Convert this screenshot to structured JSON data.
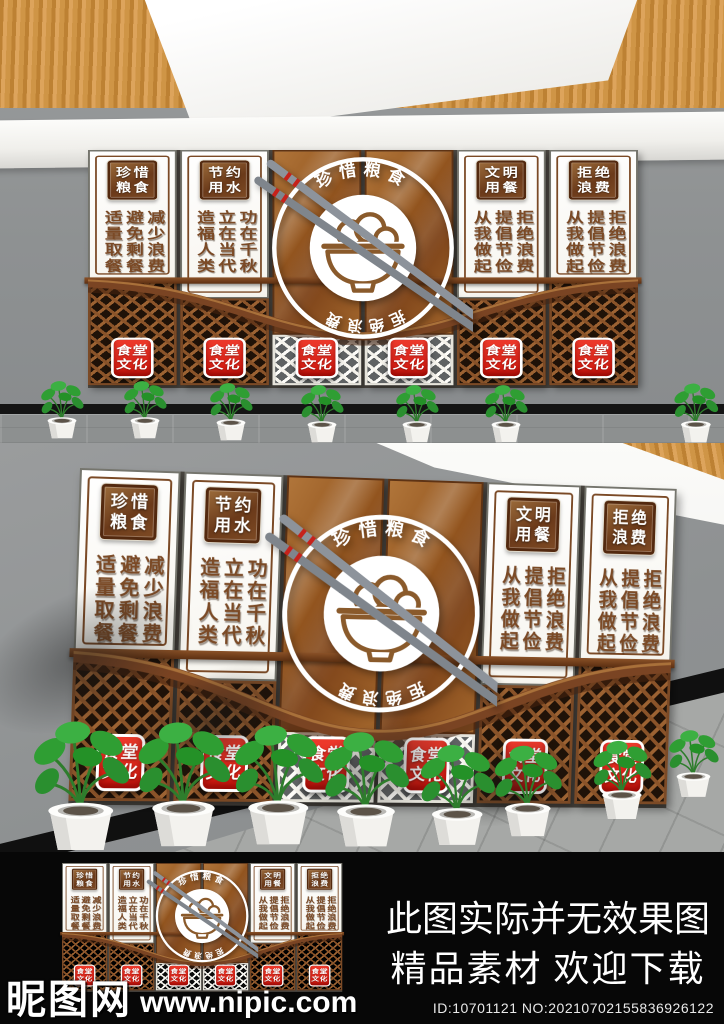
{
  "wall": {
    "panels": [
      {
        "badge_line1": "珍惜",
        "badge_line2": "粮食",
        "col_left": "适量取餐",
        "col_mid": "避免剩餐",
        "col_right": "减少浪费"
      },
      {
        "badge_line1": "节约",
        "badge_line2": "用水",
        "col_left": "造福人类",
        "col_mid": "立在当代",
        "col_right": "功在千秋"
      },
      {
        "badge_line1": "文明",
        "badge_line2": "用餐",
        "col_left": "从我做起",
        "col_mid": "提倡节俭",
        "col_right": "拒绝浪费"
      },
      {
        "badge_line1": "拒绝",
        "badge_line2": "浪费",
        "col_left": "从我做起",
        "col_mid": "提倡节俭",
        "col_right": "拒绝浪费"
      }
    ],
    "logo": {
      "arc_top": "珍惜粮食",
      "arc_bottom": "拒绝浪费"
    },
    "red_badge_line1": "食堂",
    "red_badge_line2": "文化",
    "colors": {
      "accent_red": "#d6251d",
      "panel_brown": "#8a5222",
      "text_brown": "#7b4a26",
      "wood": "#d29a52",
      "wall_gray": "#8f9192"
    }
  },
  "footer": {
    "line1": "此图实际并无效果图",
    "line2": "精品素材  欢迎下载",
    "id_text": "ID:10701121 NO:20210702155836926122",
    "watermark_cn": "昵图网",
    "watermark_url": "www.nipic.com"
  }
}
